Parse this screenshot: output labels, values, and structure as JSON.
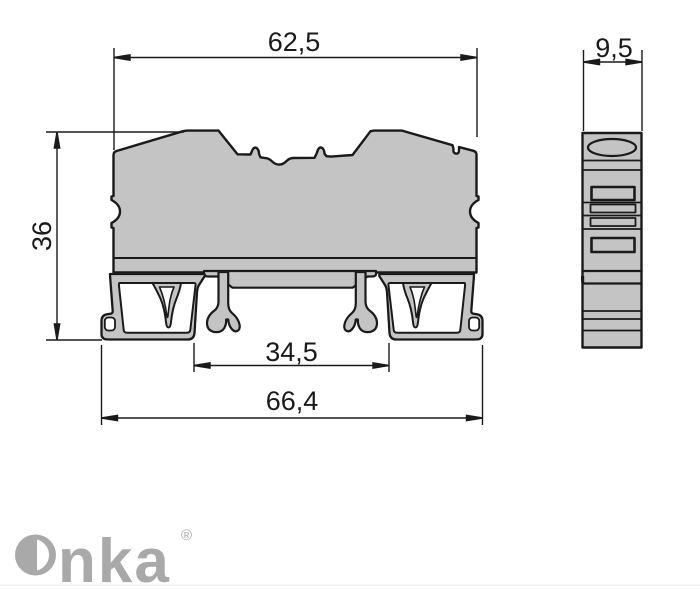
{
  "drawing": {
    "type": "technical-dimension-drawing",
    "subject": "DIN rail terminal block, front profile and side profile views",
    "dimensions": {
      "front_top_width": "62,5",
      "side_width": "9,5",
      "front_height": "36",
      "rail_inner_width": "34,5",
      "front_bottom_width": "66,4"
    },
    "colors": {
      "line": "#1a1a1a",
      "body_fill": "#c4c4c4",
      "background": "#ffffff",
      "logo": "#a9a9a9"
    }
  },
  "logo": {
    "wordmark_tail": "nka",
    "registered_mark": "®"
  }
}
